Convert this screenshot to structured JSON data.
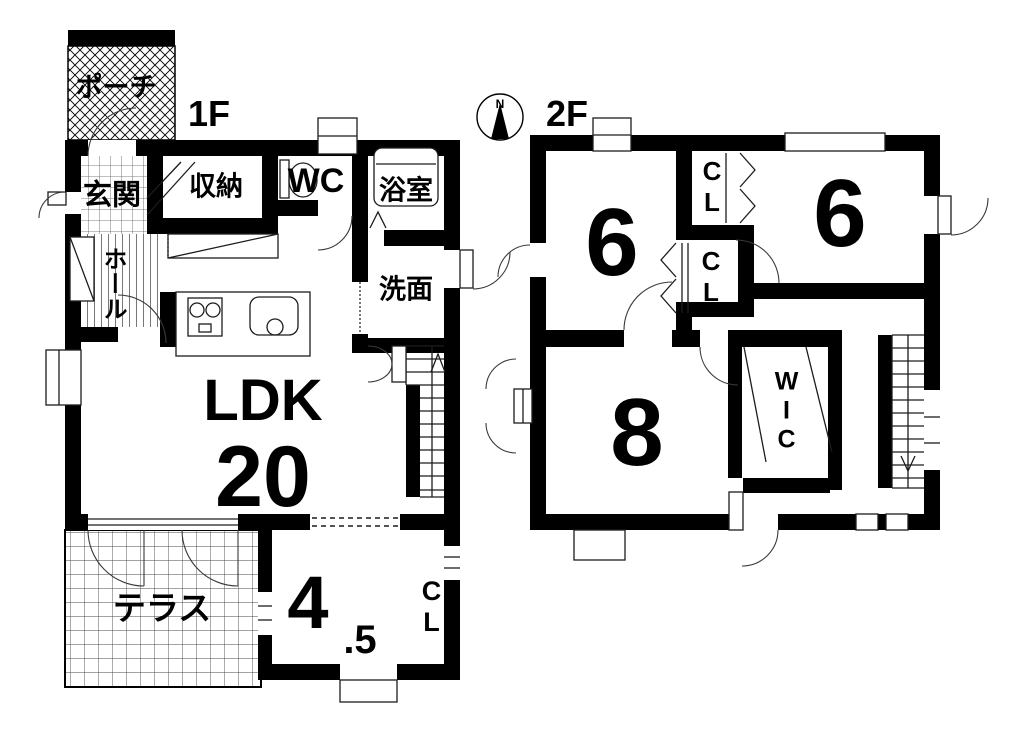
{
  "title": "floor-plan",
  "colors": {
    "ink": "#000000",
    "background": "#ffffff",
    "thin_line": "#1c1c1c"
  },
  "compass": {
    "north": "N"
  },
  "floor1": {
    "label": "1F",
    "rooms": {
      "porch": "ポーチ",
      "genkan": "玄関",
      "storage": "収納",
      "wc": "WC",
      "bathroom": "浴室",
      "washroom": "洗面",
      "hall": "ホール",
      "ldk": "LDK",
      "ldk_size": "20",
      "terrace": "テラス",
      "tatami_main": "4",
      "tatami_frac": ".5",
      "closet": "CL"
    }
  },
  "floor2": {
    "label": "2F",
    "rooms": {
      "bedroom_left": "6",
      "bedroom_right": "6",
      "closet_top": "CL",
      "closet_bottom": "CL",
      "bedroom_large": "8",
      "wic": "WIC"
    }
  }
}
